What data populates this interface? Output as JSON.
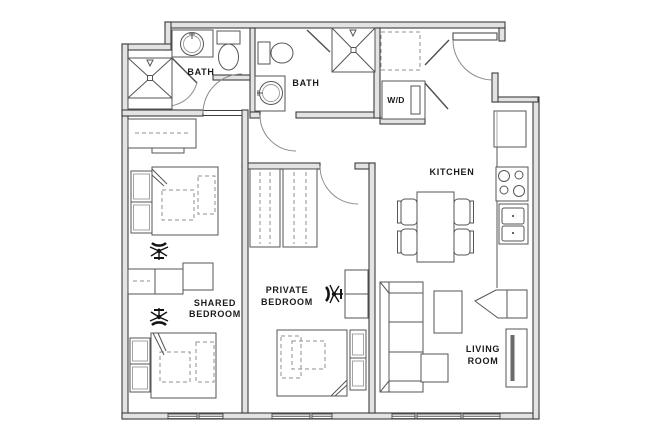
{
  "floorplan": {
    "rooms": {
      "bath_1": {
        "label": "BATH"
      },
      "bath_2": {
        "label": "BATH"
      },
      "washer_dryer": {
        "label": "W/D"
      },
      "kitchen": {
        "label": "KITCHEN"
      },
      "shared_bedroom": {
        "label_line1": "SHARED",
        "label_line2": "BEDROOM"
      },
      "private_bedroom": {
        "label_line1": "PRIVATE",
        "label_line2": "BEDROOM"
      },
      "living_room": {
        "label_line1": "LIVING",
        "label_line2": "ROOM"
      }
    },
    "colors": {
      "background": "#ffffff",
      "wall_fill": "#e3e3e3",
      "wall_stroke": "#3d3d3d",
      "furniture_stroke": "#565656",
      "label_text": "#1b1b1b"
    }
  }
}
